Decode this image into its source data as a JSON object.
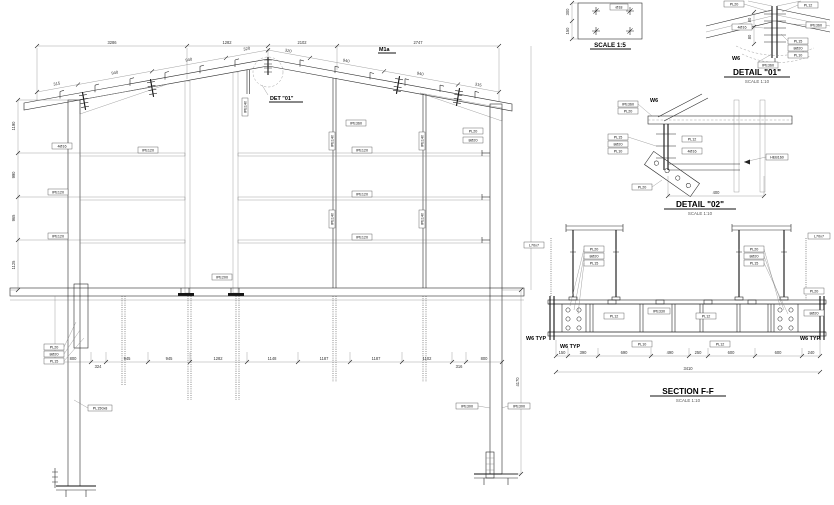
{
  "titles": {
    "detail01": "DETAIL \"01\"",
    "detail01_scale": "SCALE 1:10",
    "detail02": "DETAIL \"02\"",
    "detail02_scale": "SCALE 1:10",
    "section": "SECTION F-F",
    "section_scale": "SCALE 1:10",
    "baseplate_scale": "SCALE 1:5",
    "ridge_callout": "DET \"01\"",
    "member_tag": "M1a"
  },
  "dims": {
    "top": [
      "3286",
      "1282",
      "2102",
      "2747"
    ],
    "slope_left": [
      "315",
      "940",
      "940",
      "320"
    ],
    "slope_right": [
      "320",
      "940",
      "940",
      "315"
    ],
    "left": [
      "1190",
      "990",
      "965",
      "1125"
    ],
    "right_height": "4170",
    "bottom": [
      "800",
      "324",
      "945",
      "945",
      "1282",
      "1148",
      "1187",
      "1187",
      "1102",
      "316",
      "800"
    ],
    "baseplate": [
      "300",
      "150"
    ],
    "detail01": [
      "80",
      "80"
    ],
    "detail02_width": "400",
    "section_bottom": [
      "150",
      "390",
      "690",
      "490",
      "250",
      "600",
      "600",
      "240"
    ],
    "section_overall": "3410"
  },
  "marks": {
    "rafter": "IPE360",
    "girt": "IPE120",
    "column": "HEB160",
    "post": "IPE140",
    "jamb": "IPE200",
    "beam": "IPE330",
    "pile": "IPE300",
    "angle": "L70x7",
    "plate20": "PL20",
    "plate15": "PL15",
    "plate10": "PL10",
    "stiff": "PL12",
    "bolts8": "8Ø20",
    "bolts4": "4Ø16",
    "anchor": "Ø18",
    "base_plate": "PL150x8",
    "weld": "W6",
    "weld_note": "W6 TYP"
  }
}
